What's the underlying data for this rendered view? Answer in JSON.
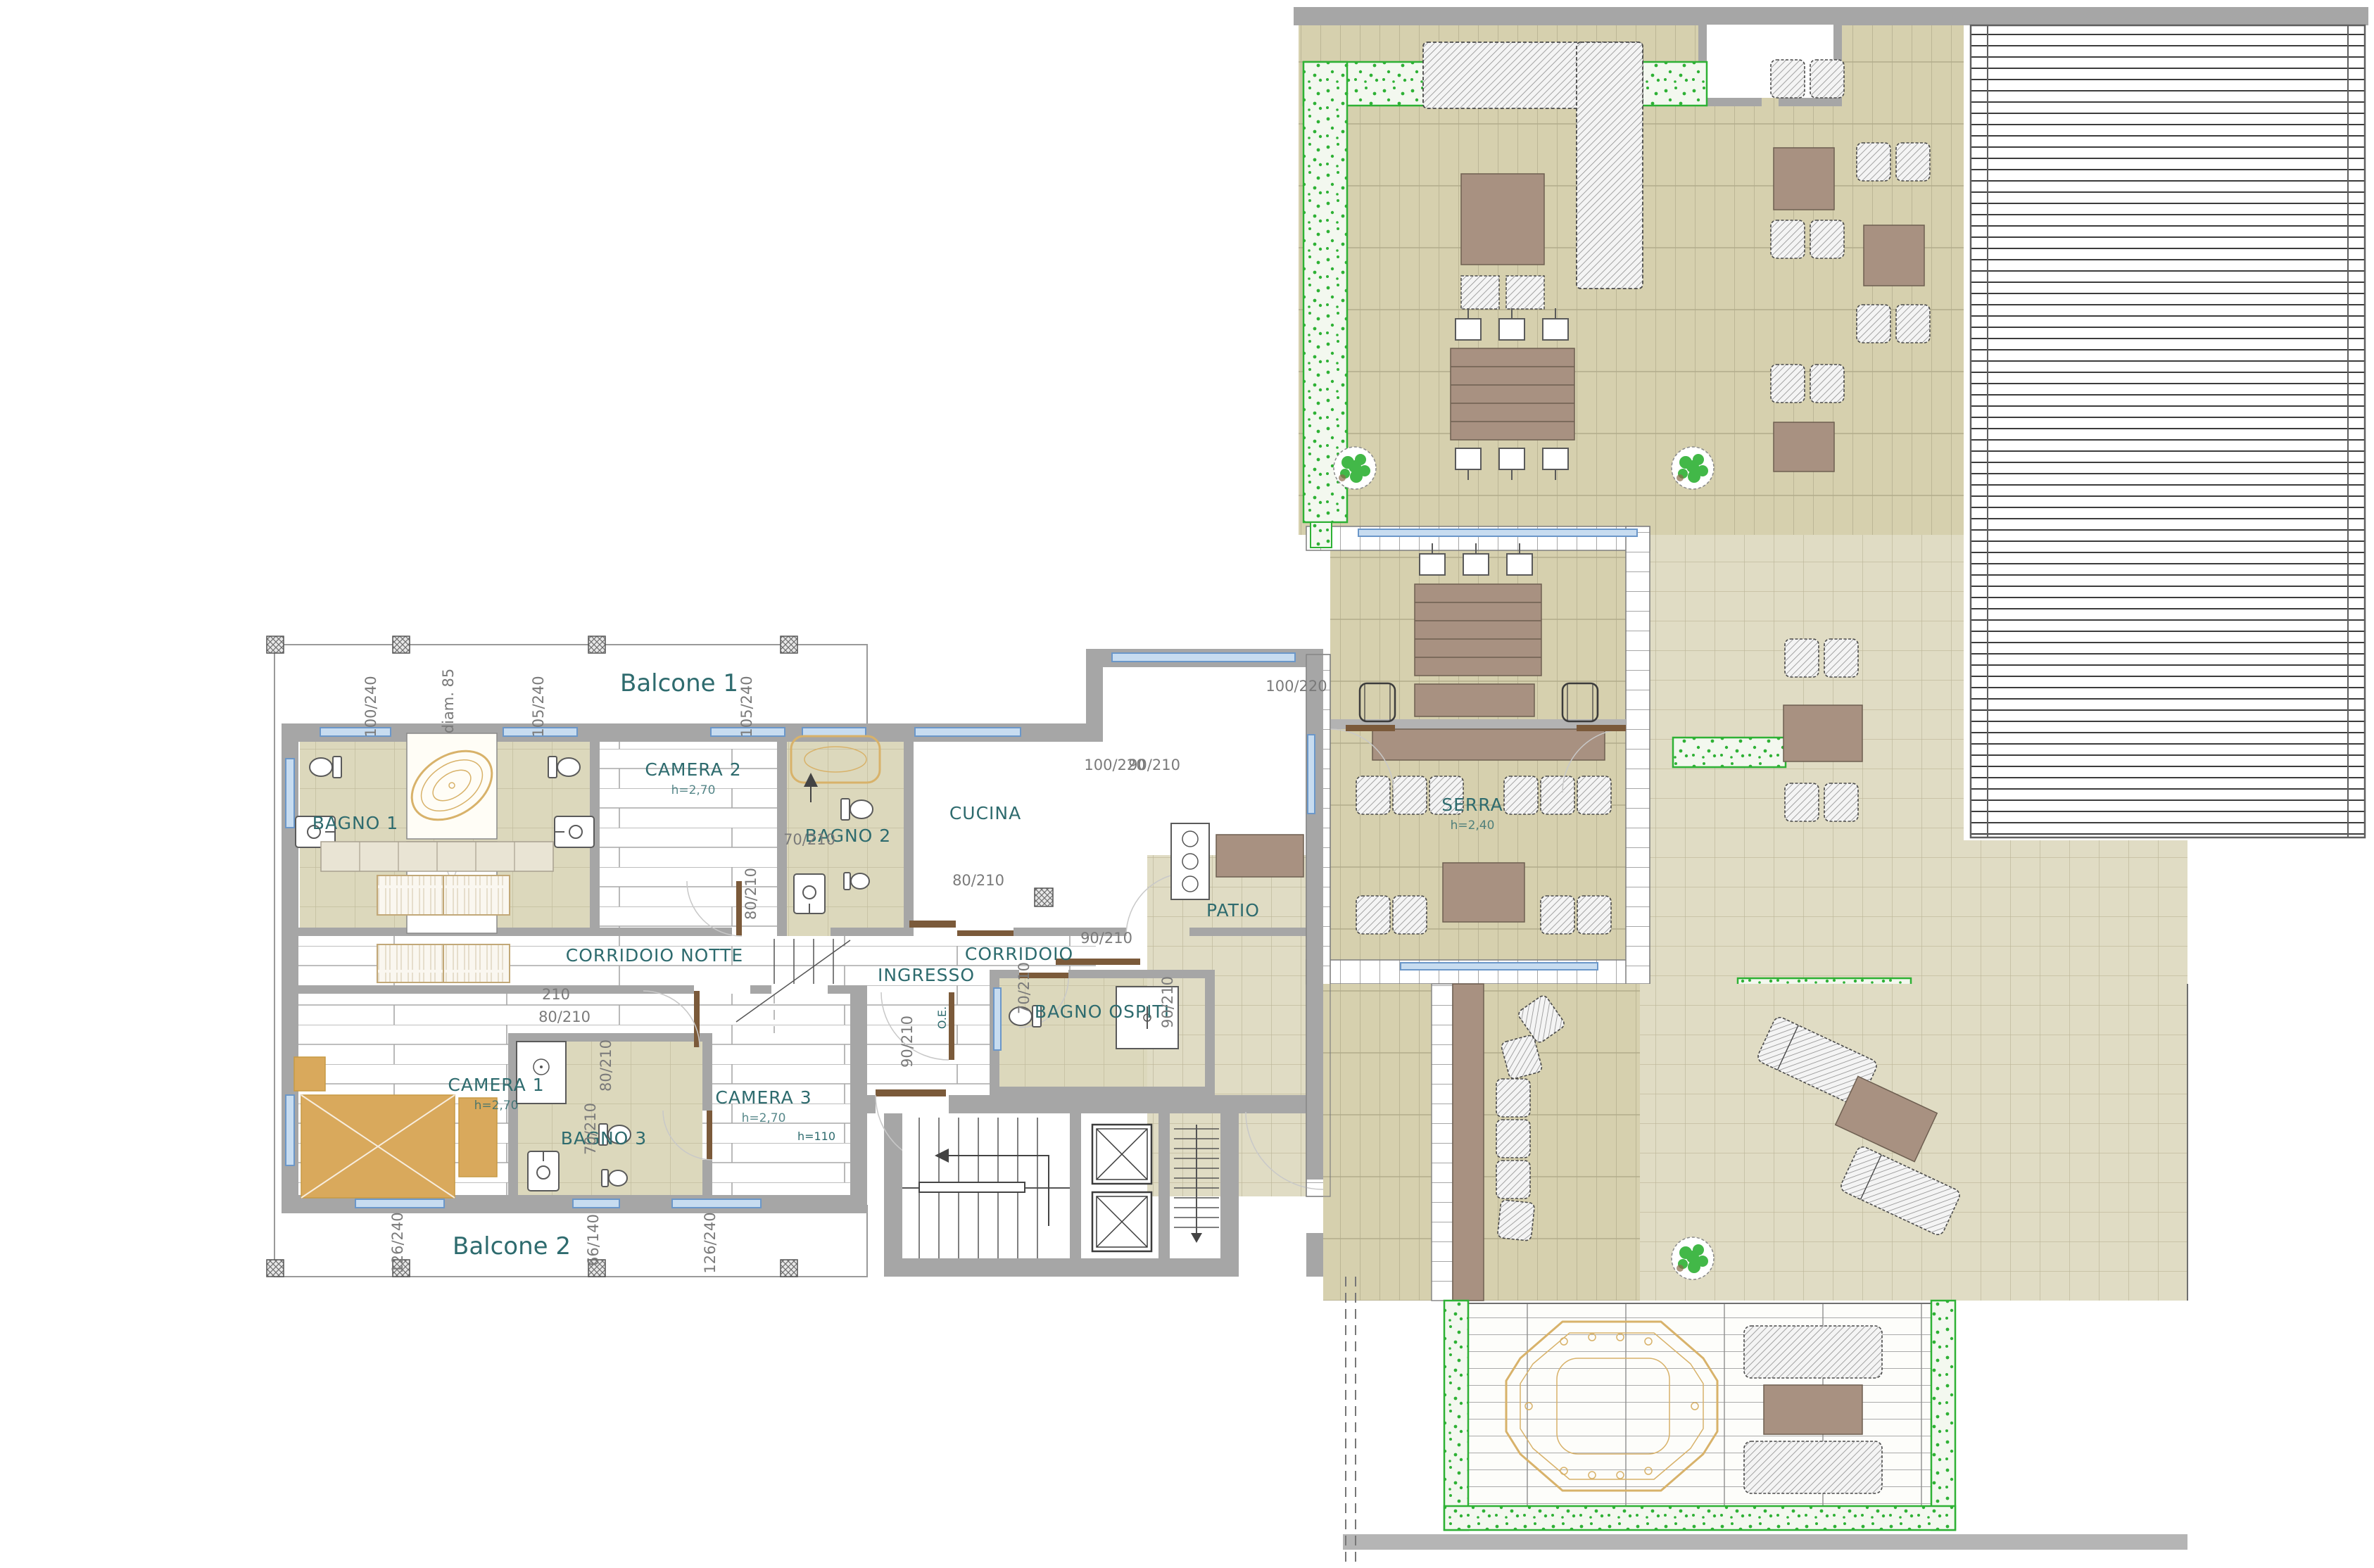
{
  "plan": {
    "title": "Attico - pianta piano (floor plan)",
    "colors": {
      "wall": "#a6a6a6",
      "wall_dark": "#7c7c7c",
      "tile": "#dcd8bc",
      "tile_line": "#c3bd9e",
      "terrace": "#d6d0ae",
      "terrace_light": "#e0dcc4",
      "plank_line": "#a8a8a8",
      "furniture_tan": "#d9a95c",
      "furniture_brown": "#a89181",
      "hedge_green": "#2eb135",
      "hedge_bg": "#f3f8ef",
      "label_teal": "#2e6b6e",
      "dim_gray": "#7a7a7a",
      "window_blue": "#c7dcf0",
      "window_stroke": "#6b97c9",
      "door_brown": "#7b5a3a",
      "gold": "#d8b26a",
      "hatch_line": "#8f8f8f"
    },
    "labels": [
      {
        "name": "label-balcone-1",
        "text": "Balcone 1",
        "cls": "lbl balcony",
        "tf": "translate(965 982)"
      },
      {
        "name": "label-balcone-2",
        "text": "Balcone 2",
        "cls": "lbl balcony",
        "tf": "translate(727 1782)"
      },
      {
        "name": "label-bagno-1",
        "text": "BAGNO 1",
        "cls": "lbl room",
        "tf": "translate(505 1178)"
      },
      {
        "name": "label-camera-2",
        "text": "CAMERA 2",
        "cls": "lbl room",
        "tf": "translate(985 1102)"
      },
      {
        "name": "label-camera-2-height",
        "text": "h=2,70",
        "cls": "lbl sub",
        "tf": "translate(985 1128)"
      },
      {
        "name": "label-bagno-2",
        "text": "BAGNO 2",
        "cls": "lbl room",
        "tf": "translate(1205 1196)"
      },
      {
        "name": "label-cucina",
        "text": "CUCINA",
        "cls": "lbl room",
        "tf": "translate(1400 1164)"
      },
      {
        "name": "label-corridoio-notte",
        "text": "CORRIDOIO NOTTE",
        "cls": "lbl room",
        "tf": "translate(930 1366)"
      },
      {
        "name": "label-corridoio",
        "text": "CORRIDOIO",
        "cls": "lbl room",
        "tf": "translate(1448 1364)"
      },
      {
        "name": "label-ingresso",
        "text": "INGRESSO",
        "cls": "lbl room",
        "tf": "translate(1316 1394)"
      },
      {
        "name": "label-oe",
        "text": "O.E.",
        "cls": "lbl tiny",
        "tf": "translate(1344 1446) rotate(-90)"
      },
      {
        "name": "label-bagno-ospiti",
        "text": "BAGNO OSPITI",
        "cls": "lbl room",
        "tf": "translate(1566 1446)"
      },
      {
        "name": "label-camera-1",
        "text": "CAMERA 1",
        "cls": "lbl room",
        "tf": "translate(705 1550)"
      },
      {
        "name": "label-camera-1-height",
        "text": "h=2,70",
        "cls": "lbl sub",
        "tf": "translate(705 1576)"
      },
      {
        "name": "label-bagno-3",
        "text": "BAGNO 3",
        "cls": "lbl room",
        "tf": "translate(858 1626)"
      },
      {
        "name": "label-camera-3",
        "text": "CAMERA 3",
        "cls": "lbl room",
        "tf": "translate(1085 1568)"
      },
      {
        "name": "label-camera-3-height",
        "text": "h=2,70",
        "cls": "lbl sub",
        "tf": "translate(1085 1594)"
      },
      {
        "name": "label-h110",
        "text": "h=110",
        "cls": "lbl tiny",
        "tf": "translate(1160 1620)"
      },
      {
        "name": "label-patio",
        "text": "PATIO",
        "cls": "lbl room",
        "tf": "translate(1752 1302)"
      },
      {
        "name": "label-serra",
        "text": "SERRA",
        "cls": "lbl room",
        "tf": "translate(2092 1152)"
      },
      {
        "name": "label-serra-height",
        "text": "h=2,40",
        "cls": "lbl sub",
        "tf": "translate(2092 1178)"
      },
      {
        "name": "dim-window-100-240",
        "text": "100/240",
        "cls": "lbl dim",
        "tf": "translate(534 1004) rotate(-90)"
      },
      {
        "name": "dim-diam-85",
        "text": "diam. 85",
        "cls": "lbl dim",
        "tf": "translate(644 996) rotate(-90)"
      },
      {
        "name": "dim-window-105-240-a",
        "text": "105/240",
        "cls": "lbl dim",
        "tf": "translate(772 1004) rotate(-90)"
      },
      {
        "name": "dim-window-105-240-b",
        "text": "105/240",
        "cls": "lbl dim",
        "tf": "translate(1068 1004) rotate(-90)"
      },
      {
        "name": "dim-window-126-240-a",
        "text": "126/240",
        "cls": "lbl dim",
        "tf": "translate(572 1766) rotate(-90)"
      },
      {
        "name": "dim-window-66-140",
        "text": "66/140",
        "cls": "lbl dim",
        "tf": "translate(850 1762) rotate(-90)"
      },
      {
        "name": "dim-window-126-240-b",
        "text": "126/240",
        "cls": "lbl dim",
        "tf": "translate(1016 1766) rotate(-90)"
      },
      {
        "name": "dim-door-70-210-a",
        "text": "70/210",
        "cls": "lbl dim",
        "tf": "translate(1150 1200)"
      },
      {
        "name": "dim-door-80-210-a",
        "text": "80/210",
        "cls": "lbl dim",
        "tf": "translate(1074 1270) rotate(-90)"
      },
      {
        "name": "dim-door-80-210-b",
        "text": "80/210",
        "cls": "lbl dim",
        "tf": "translate(1390 1258)"
      },
      {
        "name": "dim-door-90-210-a",
        "text": "90/210",
        "cls": "lbl dim",
        "tf": "translate(1572 1340)"
      },
      {
        "name": "dim-door-100-220-a",
        "text": "100/220",
        "cls": "lbl dim",
        "tf": "translate(1584 1094)"
      },
      {
        "name": "dim-door-90-210-b",
        "text": "90/210",
        "cls": "lbl dim",
        "tf": "translate(1640 1094)"
      },
      {
        "name": "dim-door-100-220-b",
        "text": "100/220",
        "cls": "lbl dim",
        "tf": "translate(1842 982)"
      },
      {
        "name": "dim-door-90-210-c",
        "text": "90/210",
        "cls": "lbl dim",
        "tf": "translate(1666 1424) rotate(-90)"
      },
      {
        "name": "dim-door-90-210-d",
        "text": "90/210",
        "cls": "lbl dim",
        "tf": "translate(1296 1480) rotate(-90)"
      },
      {
        "name": "dim-door-70-210-b",
        "text": "70/210",
        "cls": "lbl dim",
        "tf": "translate(1462 1404) rotate(-90)"
      },
      {
        "name": "dim-door-80-210-c",
        "text": "80/210",
        "cls": "lbl dim",
        "tf": "translate(802 1452)"
      },
      {
        "name": "dim-door-210",
        "text": "210",
        "cls": "lbl dim",
        "tf": "translate(790 1420)"
      },
      {
        "name": "dim-door-80-210-d",
        "text": "80/210",
        "cls": "lbl dim",
        "tf": "translate(868 1514) rotate(-90)"
      },
      {
        "name": "dim-door-70-210-c",
        "text": "70/210",
        "cls": "lbl dim",
        "tf": "translate(846 1604) rotate(-90)"
      }
    ]
  }
}
